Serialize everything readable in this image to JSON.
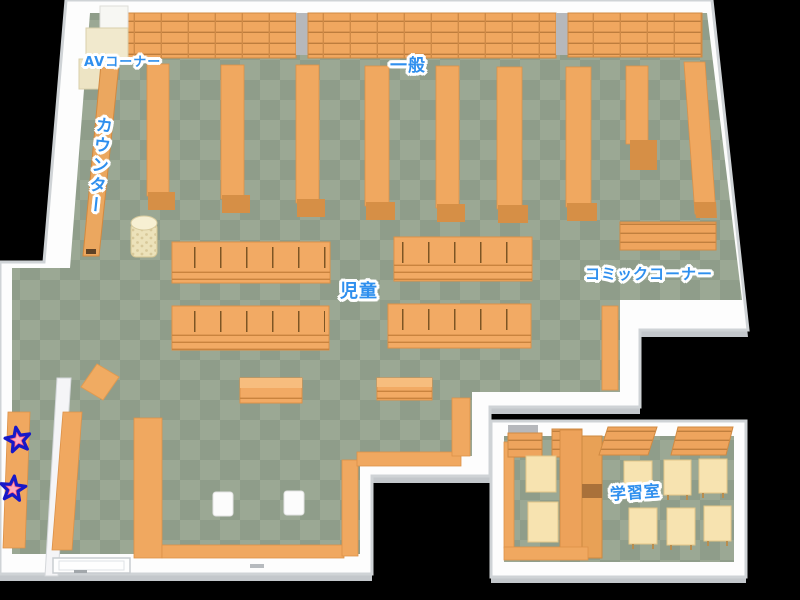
{
  "map": {
    "labels": {
      "av_corner": "AVコーナー",
      "counter": "カウンター",
      "general": "一般",
      "children": "児童",
      "comic_corner": "コミックコーナー",
      "study_room": "学習室"
    },
    "markers": {
      "count": 2,
      "shape": "star",
      "fill": "#ff5c7c",
      "outline": "#1818c8"
    },
    "colors": {
      "background": "#000000",
      "floor_dark": "#8f9d8a",
      "floor_light": "#9ba894",
      "wall": "#fdfdfd",
      "wall_shade": "#c3c7cb",
      "shelf": "#f0a860",
      "shelf_edge": "#dc9148",
      "shelf_cap": "#d68f46",
      "table_cream": "#f7e3b0",
      "av_shelf_cream": "#f1e9cd",
      "label_blue": "#2f8fee"
    }
  }
}
